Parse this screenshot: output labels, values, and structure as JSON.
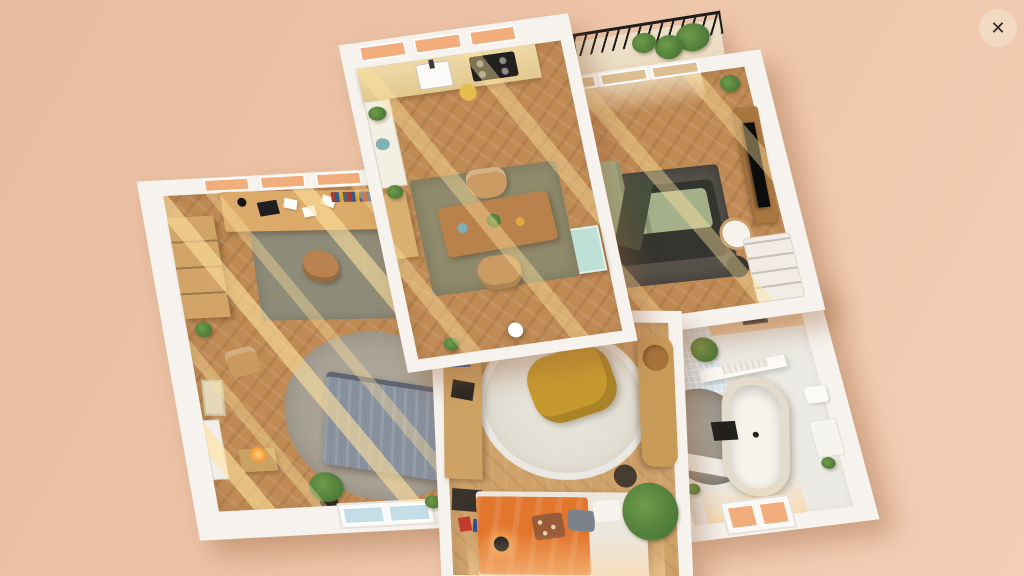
{
  "ui": {
    "close_glyph": "✕",
    "view_type": "3d-floorplan-overhead-dollhouse"
  },
  "colors": {
    "background_left": "#e8bc9f",
    "background_right": "#f3cfb6",
    "wall": "#f6f3ee",
    "floor_wood": "#bf8a54",
    "floor_bedroom": "#cfa26a",
    "floor_bath": "#eceae4",
    "window_glass_peach": "#f2ad7c",
    "window_glass_blue": "#c5dde6",
    "sunlight": "#ffe2a8",
    "rug_olive": "#8f8a6b",
    "rug_dark": "#56524a",
    "rug_round_gray": "#b3aca0",
    "rug_round_white": "#ebe8e0",
    "sofa_sage": "#a3b089",
    "sofa_base": "#34352f",
    "bed_gray": "#87909d",
    "bed_orange": "#e2762c",
    "beanbag_mustard": "#c6992f",
    "cabinet_teal": "#bfe0d6",
    "tv_black": "#0d0d0d",
    "plant_green": "#4d7a38",
    "plant_green_light": "#6f9c4a",
    "tub_white": "#f6f3ea",
    "tile_blue": "#d6e6ee",
    "railing_black": "#1c1c1c",
    "close_bg": "#f2d9c2",
    "close_fg": "#2a2a2a"
  },
  "floorplan": {
    "rooms": [
      {
        "name": "kitchen-dining",
        "furniture": [
          "kitchen-counter",
          "sink",
          "stove",
          "cutting-board",
          "fridge-cabinet",
          "sideboard",
          "teal-cabinet",
          "dining-table",
          "dining-chair",
          "dining-chair",
          "olive-rug",
          "pendant-lamp",
          "plants"
        ]
      },
      {
        "name": "living-room",
        "furniture": [
          "sofa-sectional",
          "dark-rug",
          "tv",
          "tv-console",
          "side-table",
          "stool",
          "dresser",
          "radiator",
          "french-windows",
          "plants"
        ]
      },
      {
        "name": "balcony",
        "furniture": [
          "metal-railing",
          "plants"
        ]
      },
      {
        "name": "office-bedroom",
        "furniture": [
          "desk",
          "desk-chair",
          "laptop",
          "books",
          "bookshelf",
          "wardrobe",
          "side-chair",
          "radiator-bench",
          "candle",
          "artwork",
          "bed-gray",
          "round-gray-rug",
          "desk-rug",
          "window-bench",
          "plants"
        ]
      },
      {
        "name": "bedroom",
        "furniture": [
          "orange-bed",
          "pillows",
          "round-white-rug",
          "mustard-beanbag",
          "craft-desk",
          "storage-boxes",
          "wood-cabinet",
          "stool",
          "floor-lamp",
          "plant",
          "windows"
        ]
      },
      {
        "name": "bathroom",
        "furniture": [
          "freestanding-bathtub",
          "shower",
          "bath-mat",
          "floating-shelf",
          "towel",
          "toilet",
          "storage-unit",
          "tiled-wall",
          "picture-frame",
          "window",
          "plants"
        ]
      }
    ]
  }
}
